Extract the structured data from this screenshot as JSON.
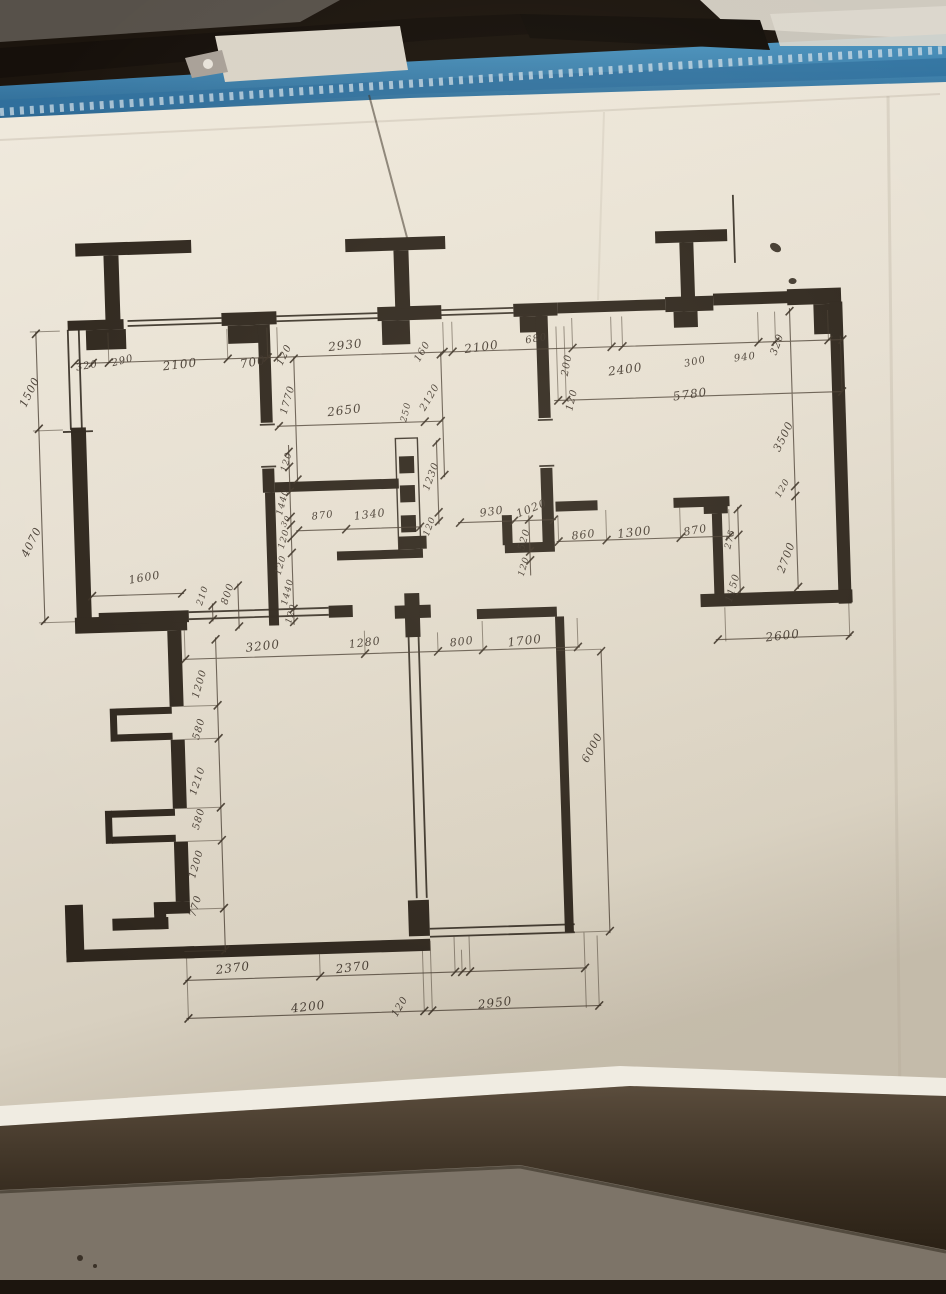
{
  "colors": {
    "paper": "#e9e3d6",
    "paper_shadow": "#c9c0af",
    "ink": "#2e261d",
    "notebook_blue": "#3f87b5",
    "background_dark": "#1c150e",
    "bottom_sheet_gray": "#7d7468"
  },
  "plan": {
    "drawing_type": "hand-drawn floor plan with dimension chains (mm)",
    "dimension_labels": [
      {
        "t": "320",
        "x": 96,
        "y": 355,
        "r": -8,
        "fs": 10
      },
      {
        "t": "290",
        "x": 132,
        "y": 351,
        "r": -12,
        "fs": 10
      },
      {
        "t": "2100",
        "x": 189,
        "y": 356,
        "r": -5,
        "fs": 12
      },
      {
        "t": "700",
        "x": 262,
        "y": 356,
        "r": -8,
        "fs": 12
      },
      {
        "t": "120",
        "x": 294,
        "y": 350,
        "r": -62,
        "fs": 10
      },
      {
        "t": "2930",
        "x": 355,
        "y": 342,
        "r": -5,
        "fs": 12
      },
      {
        "t": "160",
        "x": 432,
        "y": 351,
        "r": -58,
        "fs": 10
      },
      {
        "t": "2100",
        "x": 491,
        "y": 348,
        "r": -6,
        "fs": 12
      },
      {
        "t": "680",
        "x": 546,
        "y": 342,
        "r": -8,
        "fs": 10
      },
      {
        "t": "200",
        "x": 576,
        "y": 369,
        "r": -78,
        "fs": 10
      },
      {
        "t": "2400",
        "x": 634,
        "y": 375,
        "r": -6,
        "fs": 12
      },
      {
        "t": "300",
        "x": 704,
        "y": 370,
        "r": -10,
        "fs": 10
      },
      {
        "t": "940",
        "x": 754,
        "y": 367,
        "r": -6,
        "fs": 10
      },
      {
        "t": "320",
        "x": 787,
        "y": 355,
        "r": -68,
        "fs": 10
      },
      {
        "t": "120",
        "x": 580,
        "y": 404,
        "r": -75,
        "fs": 10
      },
      {
        "t": "5780",
        "x": 698,
        "y": 402,
        "r": -6,
        "fs": 12
      },
      {
        "t": "1770",
        "x": 296,
        "y": 395,
        "r": -72,
        "fs": 10
      },
      {
        "t": "2650",
        "x": 352,
        "y": 407,
        "r": -5,
        "fs": 12
      },
      {
        "t": "250",
        "x": 414,
        "y": 411,
        "r": -75,
        "fs": 9
      },
      {
        "t": "2120",
        "x": 438,
        "y": 397,
        "r": -58,
        "fs": 10
      },
      {
        "t": "120",
        "x": 293,
        "y": 457,
        "r": -72,
        "fs": 9
      },
      {
        "t": "1230",
        "x": 437,
        "y": 476,
        "r": -68,
        "fs": 10
      },
      {
        "t": "120",
        "x": 434,
        "y": 526,
        "r": -68,
        "fs": 9
      },
      {
        "t": "1440",
        "x": 288,
        "y": 497,
        "r": -74,
        "fs": 9
      },
      {
        "t": "870",
        "x": 327,
        "y": 512,
        "r": -5,
        "fs": 10
      },
      {
        "t": "1340",
        "x": 374,
        "y": 512,
        "r": -5,
        "fs": 11
      },
      {
        "t": "30",
        "x": 290,
        "y": 516,
        "r": -60,
        "fs": 8
      },
      {
        "t": "120",
        "x": 288,
        "y": 534,
        "r": -72,
        "fs": 9
      },
      {
        "t": "120",
        "x": 284,
        "y": 560,
        "r": -72,
        "fs": 9
      },
      {
        "t": "1440",
        "x": 290,
        "y": 587,
        "r": -74,
        "fs": 9
      },
      {
        "t": "120",
        "x": 293,
        "y": 609,
        "r": -72,
        "fs": 9
      },
      {
        "t": "930",
        "x": 496,
        "y": 513,
        "r": -6,
        "fs": 11
      },
      {
        "t": "1020",
        "x": 536,
        "y": 511,
        "r": -20,
        "fs": 11
      },
      {
        "t": "520",
        "x": 528,
        "y": 542,
        "r": -72,
        "fs": 10
      },
      {
        "t": "120",
        "x": 527,
        "y": 569,
        "r": -72,
        "fs": 9
      },
      {
        "t": "860",
        "x": 587,
        "y": 539,
        "r": -5,
        "fs": 11
      },
      {
        "t": "1300",
        "x": 638,
        "y": 538,
        "r": -5,
        "fs": 12
      },
      {
        "t": "870",
        "x": 699,
        "y": 538,
        "r": -8,
        "fs": 11
      },
      {
        "t": "3500",
        "x": 790,
        "y": 447,
        "r": -62,
        "fs": 11
      },
      {
        "t": "120",
        "x": 788,
        "y": 499,
        "r": -58,
        "fs": 9
      },
      {
        "t": "2700",
        "x": 789,
        "y": 568,
        "r": -68,
        "fs": 11
      },
      {
        "t": "275",
        "x": 734,
        "y": 548,
        "r": -75,
        "fs": 9
      },
      {
        "t": "1150",
        "x": 735,
        "y": 597,
        "r": -72,
        "fs": 10
      },
      {
        "t": "2600",
        "x": 783,
        "y": 646,
        "r": -5,
        "fs": 12
      },
      {
        "t": "1600",
        "x": 147,
        "y": 568,
        "r": -8,
        "fs": 11
      },
      {
        "t": "210",
        "x": 205,
        "y": 588,
        "r": -70,
        "fs": 9
      },
      {
        "t": "800",
        "x": 230,
        "y": 587,
        "r": -70,
        "fs": 10
      },
      {
        "t": "3200",
        "x": 263,
        "y": 640,
        "r": -5,
        "fs": 12
      },
      {
        "t": "1280",
        "x": 365,
        "y": 640,
        "r": -5,
        "fs": 11
      },
      {
        "t": "800",
        "x": 462,
        "y": 642,
        "r": -5,
        "fs": 11
      },
      {
        "t": "1700",
        "x": 525,
        "y": 643,
        "r": -5,
        "fs": 12
      },
      {
        "t": "1200",
        "x": 199,
        "y": 676,
        "r": -72,
        "fs": 10
      },
      {
        "t": "580",
        "x": 197,
        "y": 721,
        "r": -72,
        "fs": 10
      },
      {
        "t": "1210",
        "x": 194,
        "y": 773,
        "r": -70,
        "fs": 10
      },
      {
        "t": "580",
        "x": 194,
        "y": 811,
        "r": -72,
        "fs": 10
      },
      {
        "t": "1200",
        "x": 190,
        "y": 856,
        "r": -72,
        "fs": 10
      },
      {
        "t": "770",
        "x": 188,
        "y": 898,
        "r": -72,
        "fs": 10
      },
      {
        "t": "2370",
        "x": 223,
        "y": 961,
        "r": -5,
        "fs": 12
      },
      {
        "t": "2370",
        "x": 343,
        "y": 964,
        "r": -5,
        "fs": 12
      },
      {
        "t": "4200",
        "x": 297,
        "y": 1002,
        "r": -5,
        "fs": 12
      },
      {
        "t": "120",
        "x": 389,
        "y": 1005,
        "r": -58,
        "fs": 10
      },
      {
        "t": "2950",
        "x": 484,
        "y": 1004,
        "r": -5,
        "fs": 12
      },
      {
        "t": "6000",
        "x": 589,
        "y": 752,
        "r": -60,
        "fs": 11
      },
      {
        "t": "1500",
        "x": 38,
        "y": 379,
        "r": -62,
        "fs": 11
      },
      {
        "t": "4070",
        "x": 35,
        "y": 529,
        "r": -62,
        "fs": 11
      }
    ]
  }
}
